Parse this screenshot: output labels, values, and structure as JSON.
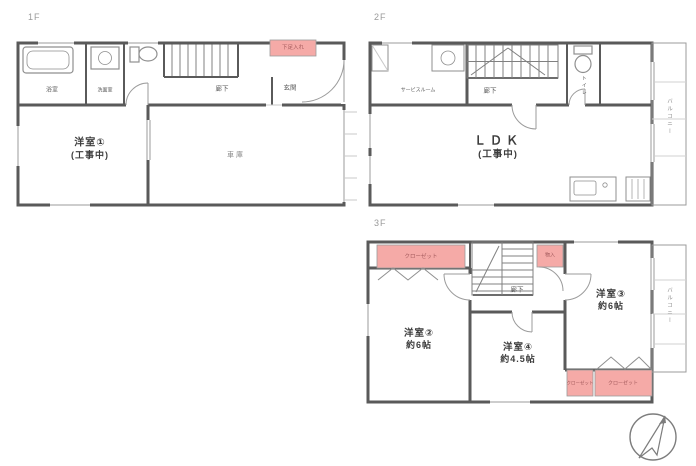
{
  "colors": {
    "wall": "#5a5a5a",
    "fixture_line": "#8f8f8f",
    "light_line": "#9b9b9b",
    "storage_fill": "#f5aaa7",
    "storage_text": "#a2595b",
    "label_text": "#3c3c3c",
    "floor_label": "#9a9a9a"
  },
  "f1": {
    "label": "1F",
    "bathroom": "浴室",
    "washroom": "洗面室",
    "corridor": "廊下",
    "entrance": "玄関",
    "shoe_cupboard": "下足入れ",
    "room1": "洋室①",
    "room1_note": "(工事中)",
    "garage": "車庫"
  },
  "f2": {
    "label": "2F",
    "service_room": "サービスルーム",
    "corridor": "廊下",
    "toilet": "トイレ",
    "ldk": "ＬＤＫ",
    "ldk_note": "(工事中)",
    "balcony": "バルコニー"
  },
  "f3": {
    "label": "3F",
    "closet_top": "クローゼット",
    "storage": "物入",
    "corridor": "廊下",
    "room2": "洋室②",
    "room2_size": "約6帖",
    "room3": "洋室③",
    "room3_size": "約6帖",
    "room4": "洋室④",
    "room4_size": "約4.5帖",
    "closet_small": "クローゼット",
    "closet_wide": "クローゼット",
    "balcony": "バルコニー"
  }
}
